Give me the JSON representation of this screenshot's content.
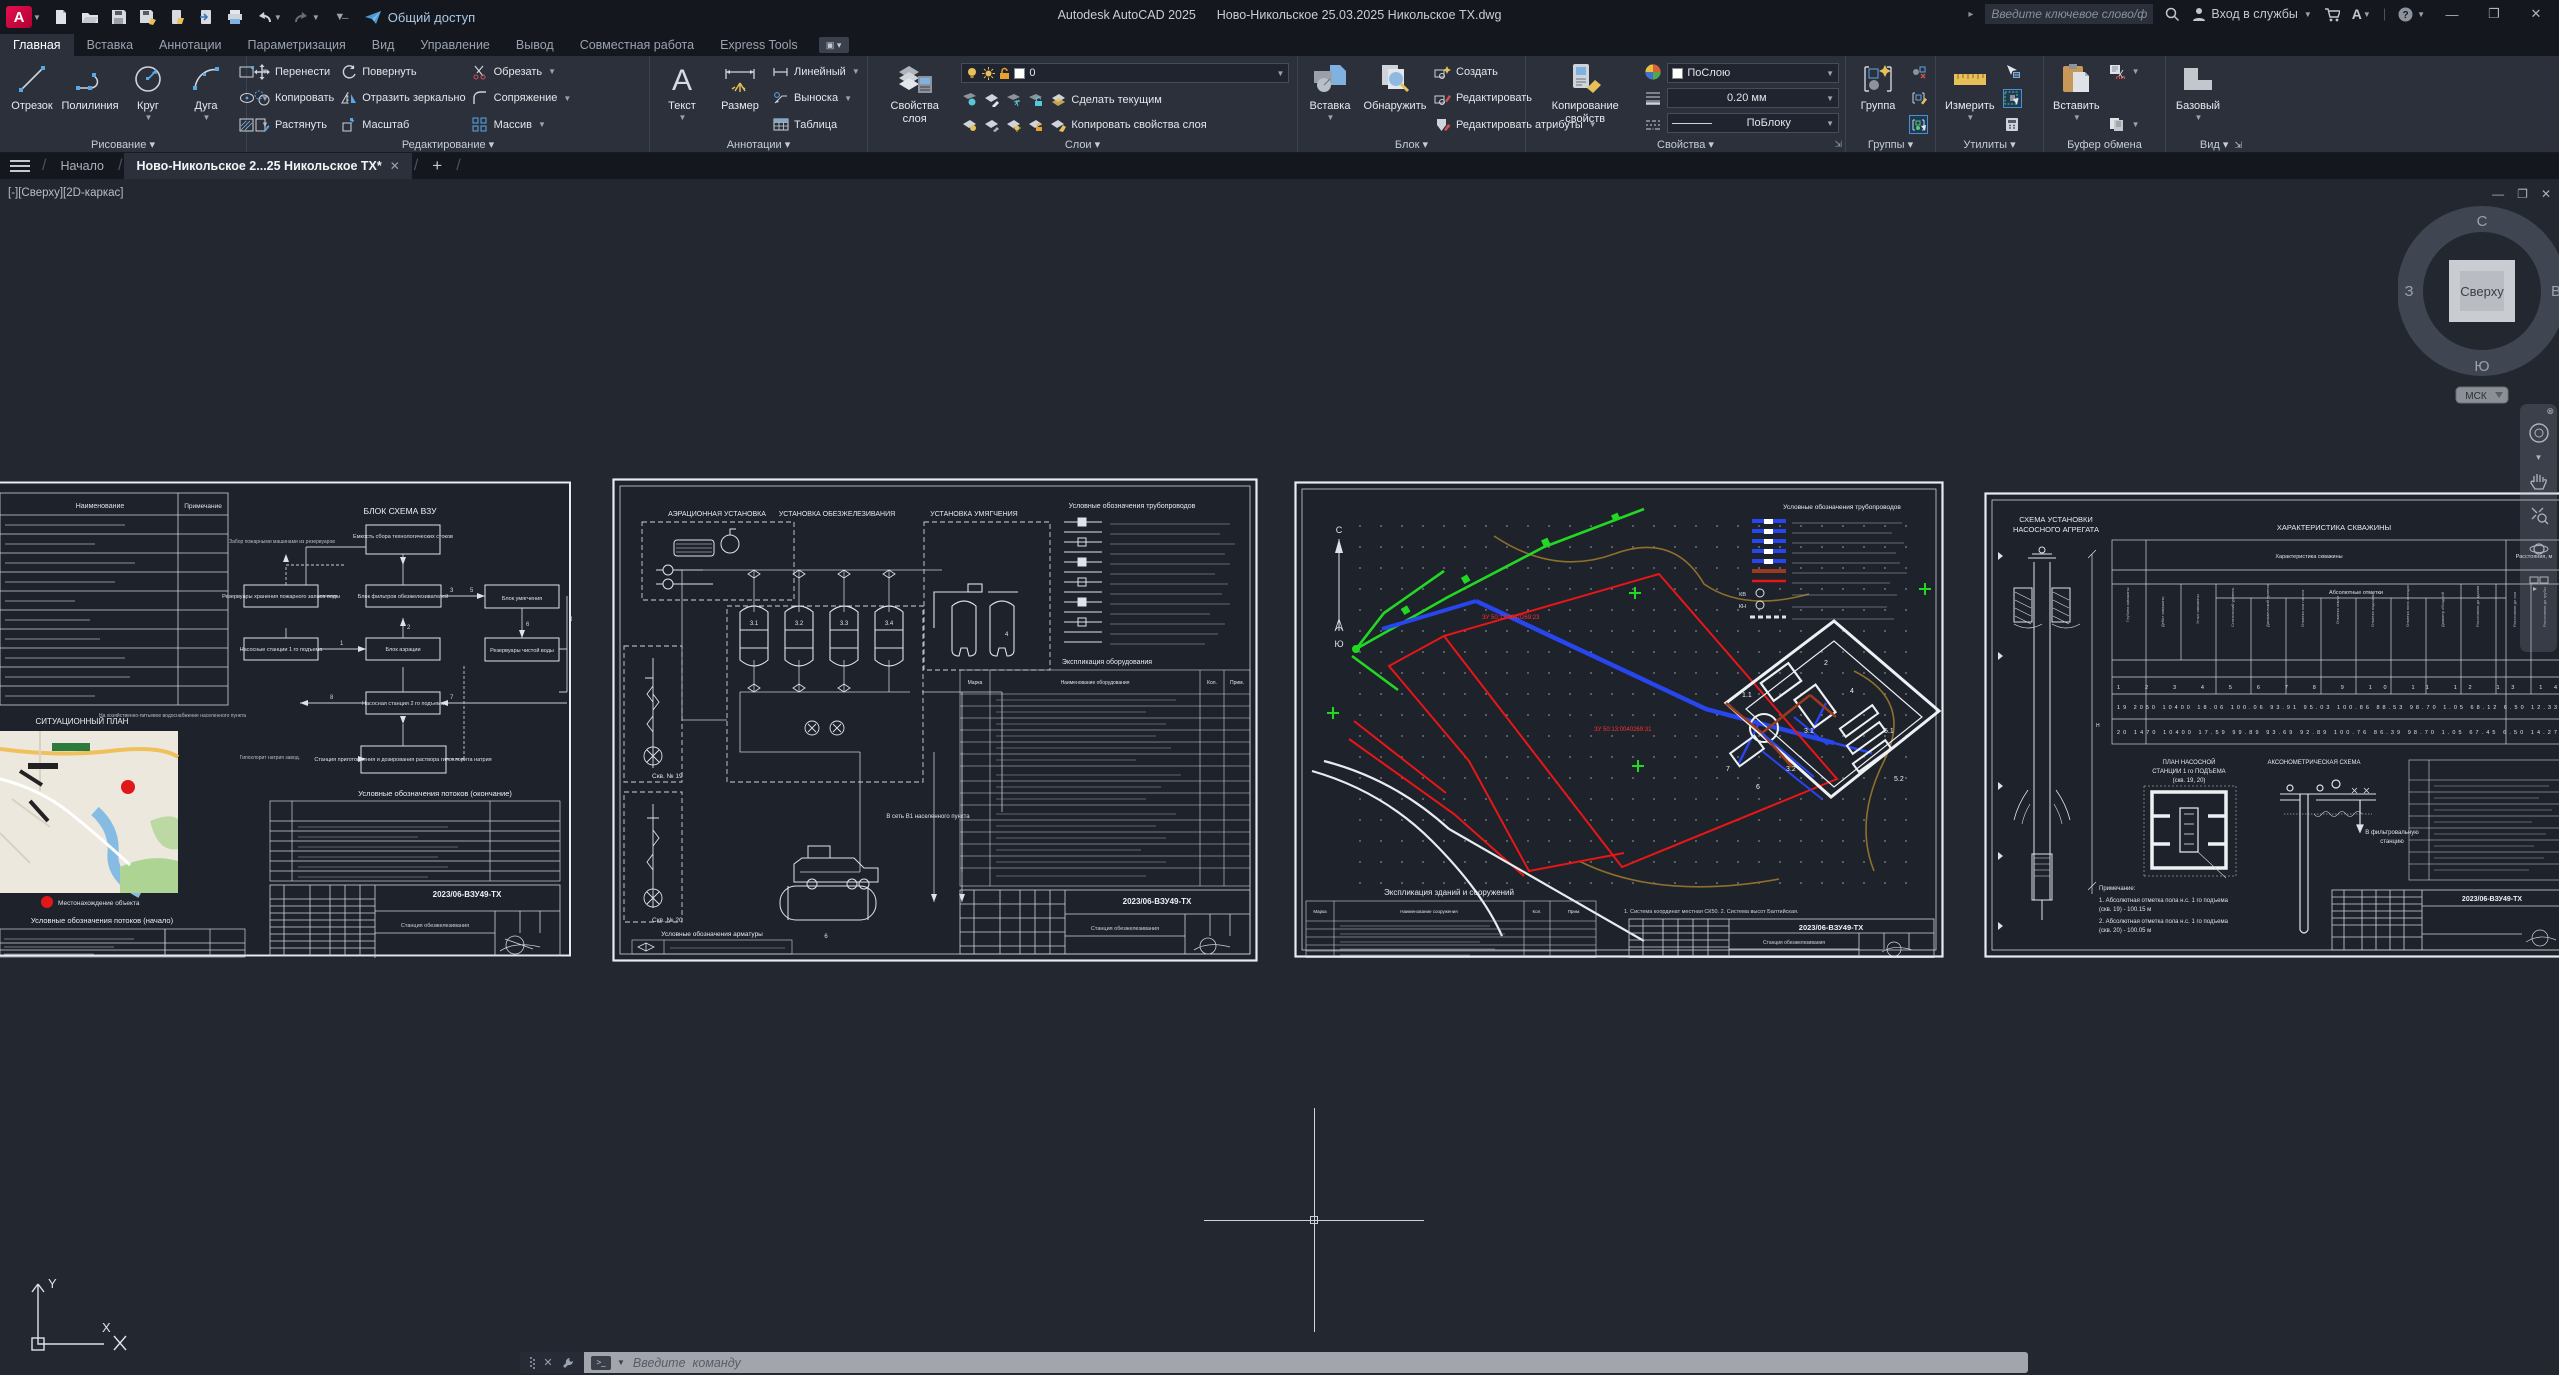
{
  "titlebar": {
    "logo": "A",
    "share": "Общий доступ",
    "title": "Autodesk AutoCAD 2025      Ново-Никольское 25.03.2025 Никольское ТХ.dwg",
    "search_placeholder": "Введите ключевое слово/фразу",
    "signin": "Вход в службы"
  },
  "tabs": {
    "items": [
      {
        "label": "Главная"
      },
      {
        "label": "Вставка"
      },
      {
        "label": "Аннотации"
      },
      {
        "label": "Параметризация"
      },
      {
        "label": "Вид"
      },
      {
        "label": "Управление"
      },
      {
        "label": "Вывод"
      },
      {
        "label": "Совместная работа"
      },
      {
        "label": "Express Tools"
      }
    ]
  },
  "ribbon": {
    "draw": {
      "title": "Рисование",
      "line": "Отрезок",
      "pline": "Полилиния",
      "circle": "Круг",
      "arc": "Дуга"
    },
    "edit": {
      "title": "Редактирование",
      "move": "Перенести",
      "copy": "Копировать",
      "stretch": "Растянуть",
      "rotate": "Повернуть",
      "mirror": "Отразить зеркально",
      "scale": "Масштаб",
      "trim": "Обрезать",
      "fillet": "Сопряжение",
      "array": "Массив"
    },
    "annot": {
      "title": "Аннотации",
      "text": "Текст",
      "dim": "Размер",
      "linear": "Линейный",
      "leader": "Выноска",
      "table": "Таблица"
    },
    "layers": {
      "title": "Слои",
      "props": "Свойства слоя",
      "current_layer": "0",
      "make_current": "Сделать текущим",
      "match": "Копировать свойства слоя"
    },
    "block": {
      "title": "Блок",
      "insert": "Вставка",
      "detect": "Обнаружить",
      "create": "Создать",
      "edit": "Редактировать",
      "edit_attrs": "Редактировать атрибуты"
    },
    "props": {
      "title": "Свойства",
      "match": "Копирование свойств",
      "color": "ПоСлою",
      "lineweight": "0.20 мм",
      "linetype": "ПоБлоку"
    },
    "groups": {
      "title": "Группы",
      "group": "Группа"
    },
    "utils": {
      "title": "Утилиты",
      "measure": "Измерить"
    },
    "clipboard": {
      "title": "Буфер обмена",
      "paste": "Вставить"
    },
    "view": {
      "title": "Вид",
      "base": "Базовый"
    }
  },
  "doc_tabs": {
    "start": "Начало",
    "current": "Ново-Никольское 2...25 Никольское ТХ*"
  },
  "viewport": {
    "label": "[-][Сверху][2D-каркас]"
  },
  "viewcube": {
    "top": "Сверху",
    "n": "С",
    "e": "В",
    "s": "Ю",
    "w": "З",
    "ucs": "МСК"
  },
  "command": {
    "placeholder": "Введите  команду"
  },
  "ucs": {
    "x": "X",
    "y": "Y"
  },
  "sheets": {
    "doc_number": "2023/06-ВЗУ49-ТХ",
    "s1": {
      "col_name": "Наименование",
      "col_note": "Примечание",
      "flow_title": "БЛОК СХЕМА ВЗУ",
      "b1": "Насосные станции 1 го подъема",
      "b2": "Блок аэрации",
      "b3": "Блок фильтров обезжелезивателей",
      "b4": "Блок умягчения",
      "b5": "Резервуары чистой воды",
      "b6": "Насосная станция 2 го подъема",
      "b7": "Емкость сбора технологических стоков",
      "b8": "Резервуары хранения пожарного запаса воды",
      "b9": "Станция приготовления и дозирования раствора гипохлорита натрия",
      "out_text": "На хозяйственно-питьевое водоснабжение населенного пункта",
      "in_text": "Гипохлорит натрия завод.",
      "top_text": "Забор пожарными машинами из резервуаров",
      "map_title": "СИТУАЦИОННЫЙ ПЛАН",
      "map_legend": "Местонахождение объекта",
      "legend_start": "Условные обозначения потоков (начало)",
      "legend_end": "Условные обозначения потоков (окончание)",
      "stamp_title": "Станция обезжелезивания"
    },
    "s2": {
      "t1": "АЭРАЦИОННАЯ УСТАНОВКА",
      "t2": "УСТАНОВКА ОБЕЗЖЕЛЕЗИВАНИЯ",
      "t3": "УСТАНОВКА УМЯГЧЕНИЯ",
      "legend_pipes": "Условные обозначения трубопроводов",
      "equip": "Экспликация оборудования",
      "legend_valves": "Условные обозначения арматуры",
      "well19": "Скв. № 19",
      "well20": "Скв. № 20",
      "to_net": "В сеть В1 населенного пункта",
      "stamp_title": "Станция обезжелезивания"
    },
    "s3": {
      "legend": "Условные обозначения трубопроводов",
      "expl": "Экспликация зданий и сооружений",
      "n": "С",
      "s": "Ю",
      "zu1": "ЗУ 50:13:0040269:23",
      "zu2": "ЗУ 50:13:0040269:31",
      "notes": "1. Система координат местная СК50.  2. Система высот Балтийская.",
      "stamp_title": "Станция обезжелезивания"
    },
    "s4": {
      "scheme1": "СХЕМА УСТАНОВКИ",
      "scheme2": "НАСОСНОГО АГРЕГАТА",
      "char": "ХАРАКТЕРИСТИКА СКВАЖИНЫ",
      "char_sub": "Характеристика скважины",
      "char_abs": "Абсолютные отметки",
      "char_dist": "Расстояния, м",
      "plan1": "ПЛАН НАСОСНОЙ",
      "plan2": "СТАНЦИИ 1 го ПОДЪЕМА",
      "plan3": "(скв. 19, 20)",
      "axo": "АКСОНОМЕТРИЧЕСКАЯ СХЕМА",
      "filter1": "В фильтровальную",
      "filter2": "станцию",
      "notes_title": "Примечание:",
      "note1": "1. Абсолютная отметка пола н.с. 1 го подъема",
      "note1b": "(скв. 19) - 100.15 м",
      "note2": "2. Абсолютная отметка пола н.с. 1 го подъема",
      "note2b": "(скв. 20) - 100.05 м",
      "chart_data": {
        "type": "table",
        "title": "ХАРАКТЕРИСТИКА СКВАЖИНЫ",
        "columns": [
          "1",
          "2",
          "3",
          "4",
          "5",
          "6",
          "7",
          "8",
          "9",
          "10",
          "11",
          "12",
          "13",
          "14"
        ],
        "rows": [
          [
            "19",
            "2050",
            "10400",
            "18.06",
            "100.06",
            "93.91",
            "95.03",
            "100.86",
            "88.53",
            "98.70",
            "1.05",
            "68.12",
            "6.50",
            "12.33"
          ],
          [
            "20",
            "1470",
            "10400",
            "17.59",
            "99.89",
            "93.69",
            "92.89",
            "100.76",
            "86.39",
            "98.70",
            "1.05",
            "67.45",
            "6.50",
            "14.27"
          ]
        ]
      }
    }
  }
}
